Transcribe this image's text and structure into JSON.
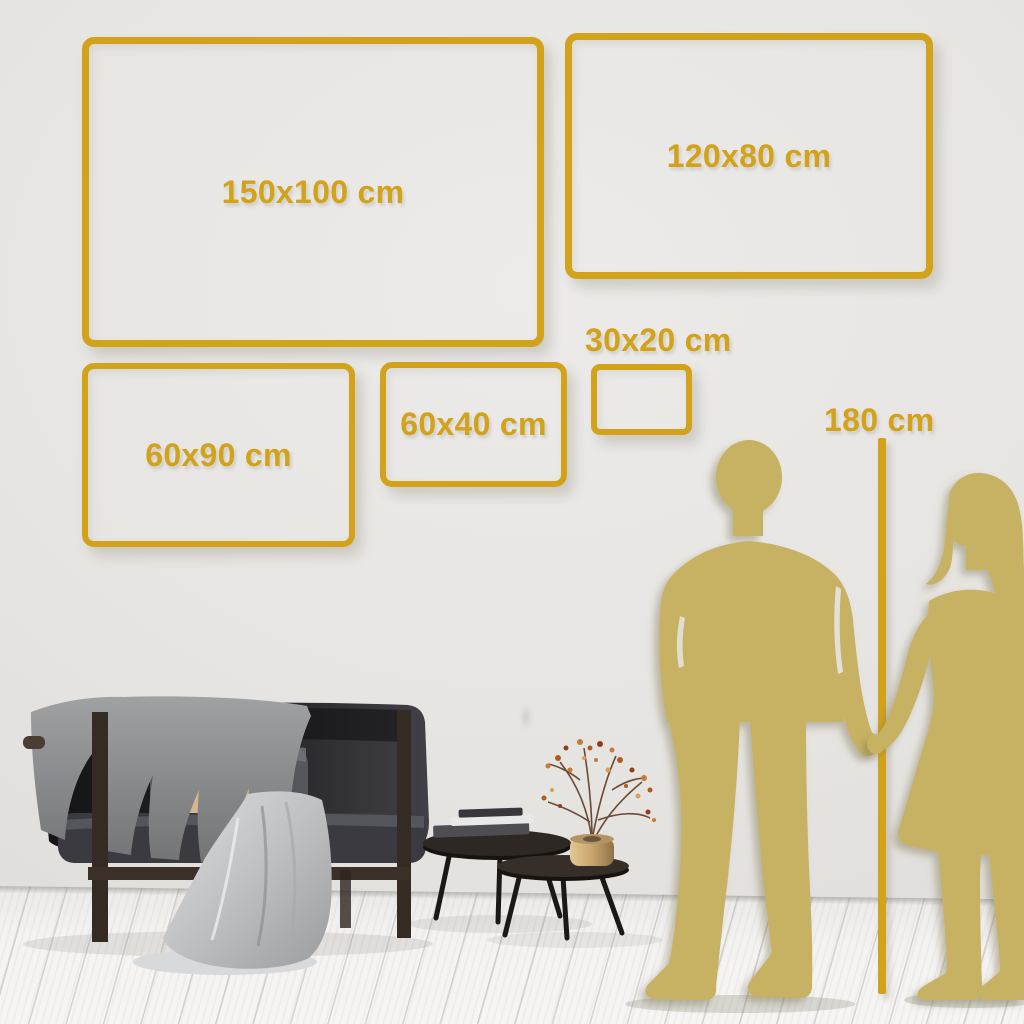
{
  "frames": [
    {
      "name": "150x100",
      "label": "150x100 cm"
    },
    {
      "name": "120x80",
      "label": "120x80 cm"
    },
    {
      "name": "60x90",
      "label": "60x90 cm"
    },
    {
      "name": "60x40",
      "label": "60x40 cm"
    },
    {
      "name": "30x20",
      "label": "30x20 cm"
    }
  ],
  "height_marker": {
    "label": "180 cm"
  },
  "colors": {
    "accent_gold": "#d2a21a",
    "silhouette_gold": "#c7b164",
    "wall": "#e6e4e1",
    "floor": "#f4f3f1"
  },
  "scene": {
    "silhouettes": [
      "man",
      "woman"
    ],
    "furniture": [
      "dark-sofa",
      "gray-blanket",
      "satin-throw",
      "pillows",
      "nesting-coffee-tables",
      "books",
      "gold-vase",
      "dried-branch-plant"
    ]
  }
}
